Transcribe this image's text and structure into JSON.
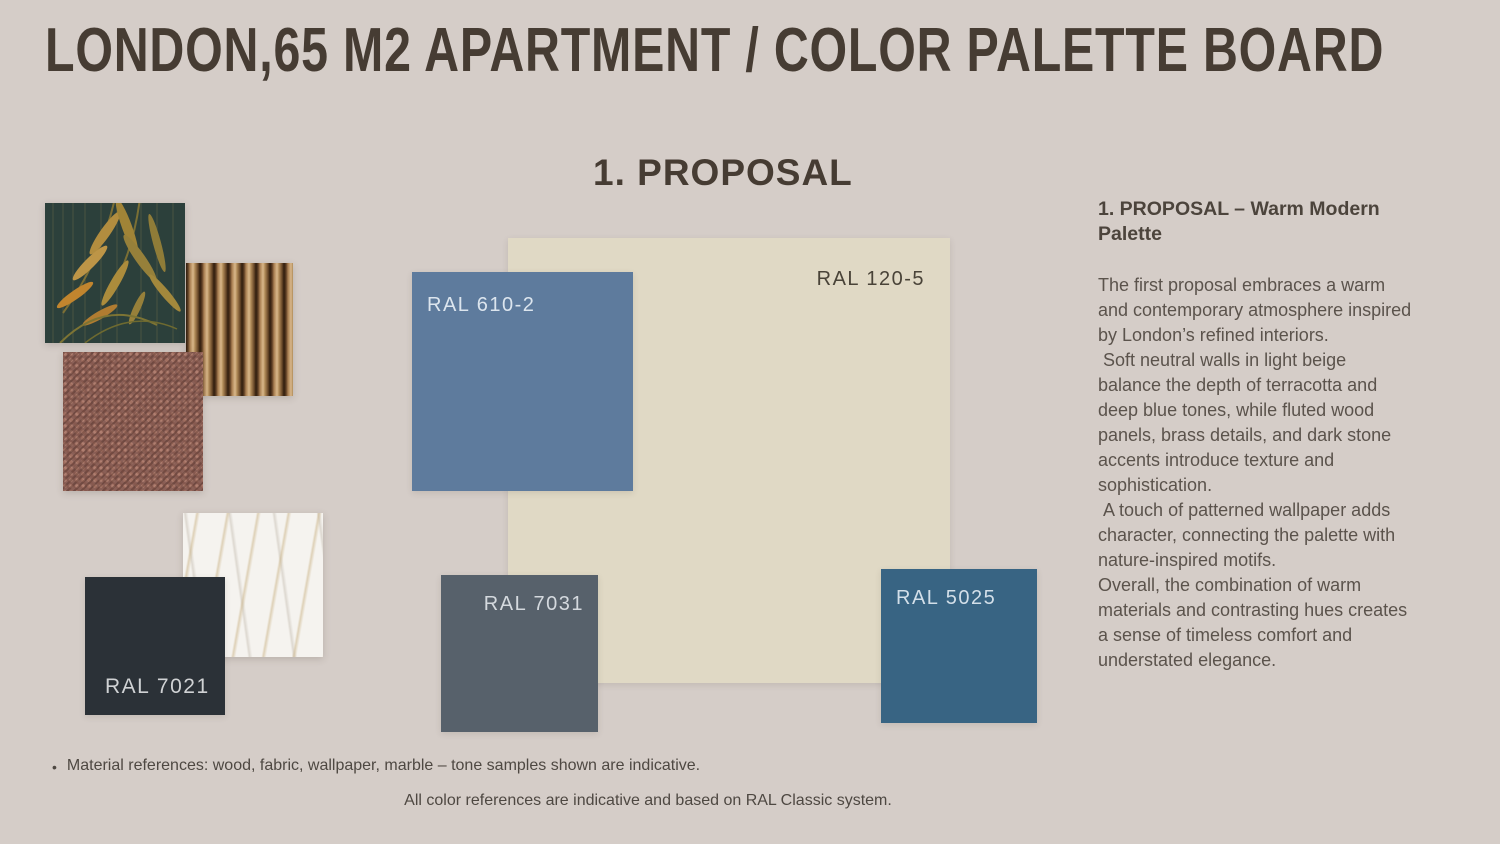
{
  "header": {
    "title": "LONDON,65 M2 APARTMENT / COLOR PALETTE BOARD"
  },
  "section": {
    "heading": "1. PROPOSAL"
  },
  "palette": {
    "ral_610_2": {
      "code": "RAL 610-2",
      "hex": "#5e7b9d",
      "label_color": "#dce5ee"
    },
    "ral_120_5": {
      "code": "RAL 120-5",
      "hex": "#e0d9c5",
      "label_color": "#494338"
    },
    "ral_7031": {
      "code": "RAL 7031",
      "hex": "#57616b",
      "label_color": "#d4d9de"
    },
    "ral_5025": {
      "code": "RAL 5025",
      "hex": "#386483",
      "label_color": "#d3dfe9"
    },
    "ral_7021": {
      "code": "RAL 7021",
      "hex": "#2b3137",
      "label_color": "#d0d2d4"
    }
  },
  "material_colors": {
    "wallpaper_base": "#2c403b",
    "wallpaper_leaf": "#b28d3f",
    "wood_light": "#d9b88a",
    "wood_dark": "#2f1d0e",
    "fabric_base": "#8a5f56",
    "marble_base": "#f5f3ef",
    "marble_vein": "#cbb488"
  },
  "description": {
    "heading": "1. PROPOSAL – Warm Modern Palette",
    "paragraphs": [
      "The first proposal embraces a warm and contemporary atmosphere inspired by London’s refined interiors.",
      " Soft neutral walls in light beige balance the depth of terracotta and deep blue tones, while fluted wood panels, brass details, and dark stone accents introduce texture and sophistication.",
      " A touch of patterned wallpaper adds character, connecting the palette with nature-inspired motifs.",
      "Overall, the combination of warm materials and contrasting hues creates a sense of timeless comfort and understated elegance."
    ]
  },
  "footnotes": {
    "bullet_glyph": "•",
    "bullet": "Material references: wood, fabric, wallpaper, marble – tone samples shown are indicative.",
    "footer": "All color references are indicative and based on RAL Classic system."
  }
}
